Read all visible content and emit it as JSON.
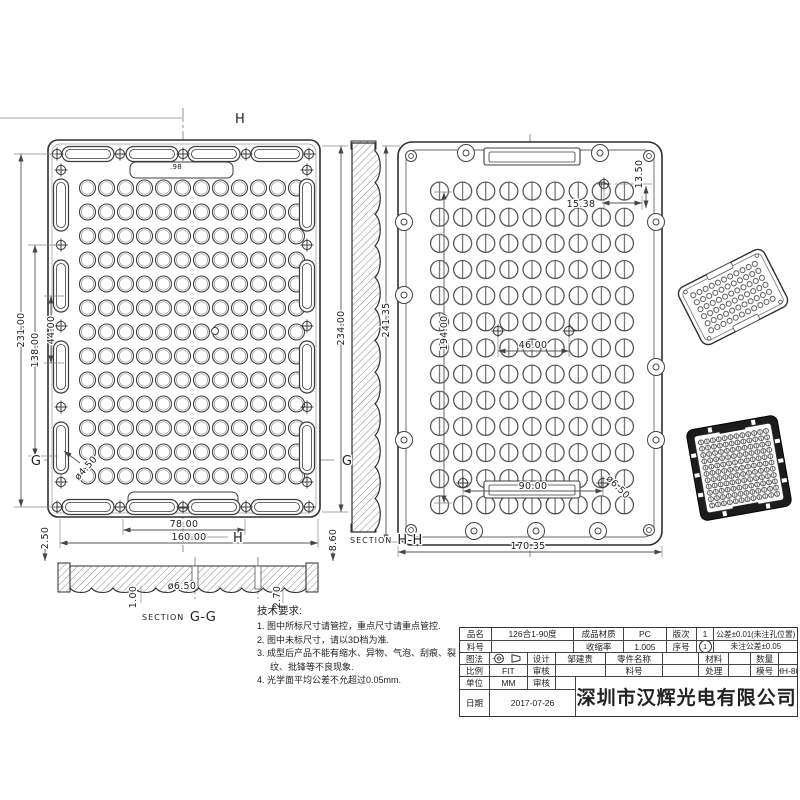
{
  "sections": {
    "word": "SECTION",
    "gg": "G-G",
    "hh": "H-H",
    "h_marker": "H",
    "g_marker": "G"
  },
  "dims": {
    "left_total_h": "231.00",
    "left_mid_h": "138.00",
    "left_small_h": "44.00",
    "left_right_h": "234.00",
    "lens_note": ".98",
    "hole_d_small": "ø4.50",
    "bottom_inner_w": "78.00",
    "bottom_outer_w": "160.00",
    "sec_left_t": "2.50",
    "sec_right_t": "8.60",
    "gg_t1": "1.00",
    "gg_hole": "ø6.50",
    "gg_t2": "2.70",
    "right_total_h": "241.35",
    "right_inner_h": "194.00",
    "right_p1": "15.38",
    "right_p2": "13.50",
    "right_center_w": "46.00",
    "right_win_w": "90.00",
    "right_hole": "ø6.50",
    "right_outer_w": "170.35"
  },
  "tech": {
    "title": "技术要求:",
    "items": [
      "1. 图中所标尺寸请管控，重点尺寸请重点管控.",
      "2. 图中未标尺寸，请以3D档为准.",
      "3. 成型后产品不能有缩水、异物、气泡、刮痕、裂纹、批锋等不良现象.",
      "4. 光学面平均公差不允超过0.05mm."
    ]
  },
  "title_block": {
    "product_label": "品名",
    "product": "126合1-90度",
    "material_label": "成品材质",
    "material": "PC",
    "version_label": "版次",
    "version": "1",
    "tol1": "公差±0.01(未注孔位置)",
    "part_no_label": "料号",
    "part_no": "",
    "shrink_label": "收缩率",
    "shrink": "1.005",
    "serial_label": "序号",
    "serial": "1",
    "tol2": "未注公差±0.05",
    "projection_label": "图法",
    "design_label": "设计",
    "designer": "邹建贵",
    "part_name_label": "零件名称",
    "part_name": "",
    "mat_label": "材料",
    "mat": "",
    "qty_label": "数量",
    "qty": "",
    "scale_label": "比例",
    "scale": "FIT",
    "check_label": "审核",
    "check": "",
    "part_no2_label": "料号",
    "part_no2": "",
    "treat_label": "处理",
    "treat": "",
    "mold_label": "模号",
    "mold": "HH-80",
    "unit_label": "单位",
    "unit": "MM",
    "check2_label": "审核",
    "check2": "",
    "date_label": "日期",
    "date": "2017-07-26",
    "company": "深圳市汉辉光电有限公司"
  },
  "colors": {
    "line": "#2f2f2f",
    "dim_line": "#555555",
    "iso_back_frame": "#1c1c1c"
  }
}
